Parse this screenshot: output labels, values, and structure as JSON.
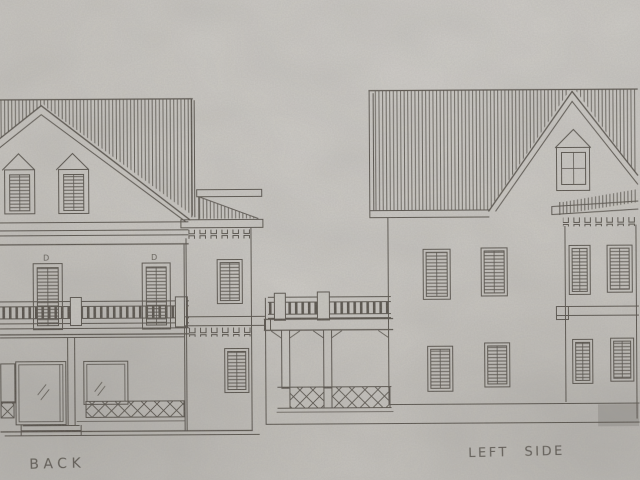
{
  "colors": {
    "paper": "#c9c6c1",
    "ink": "#47423b"
  },
  "drawing": {
    "back_elevation": {
      "label": "BACK",
      "door_marker_left": "D",
      "door_marker_right": "D"
    },
    "left_side_elevation": {
      "label": "LEFT SIDE"
    }
  }
}
